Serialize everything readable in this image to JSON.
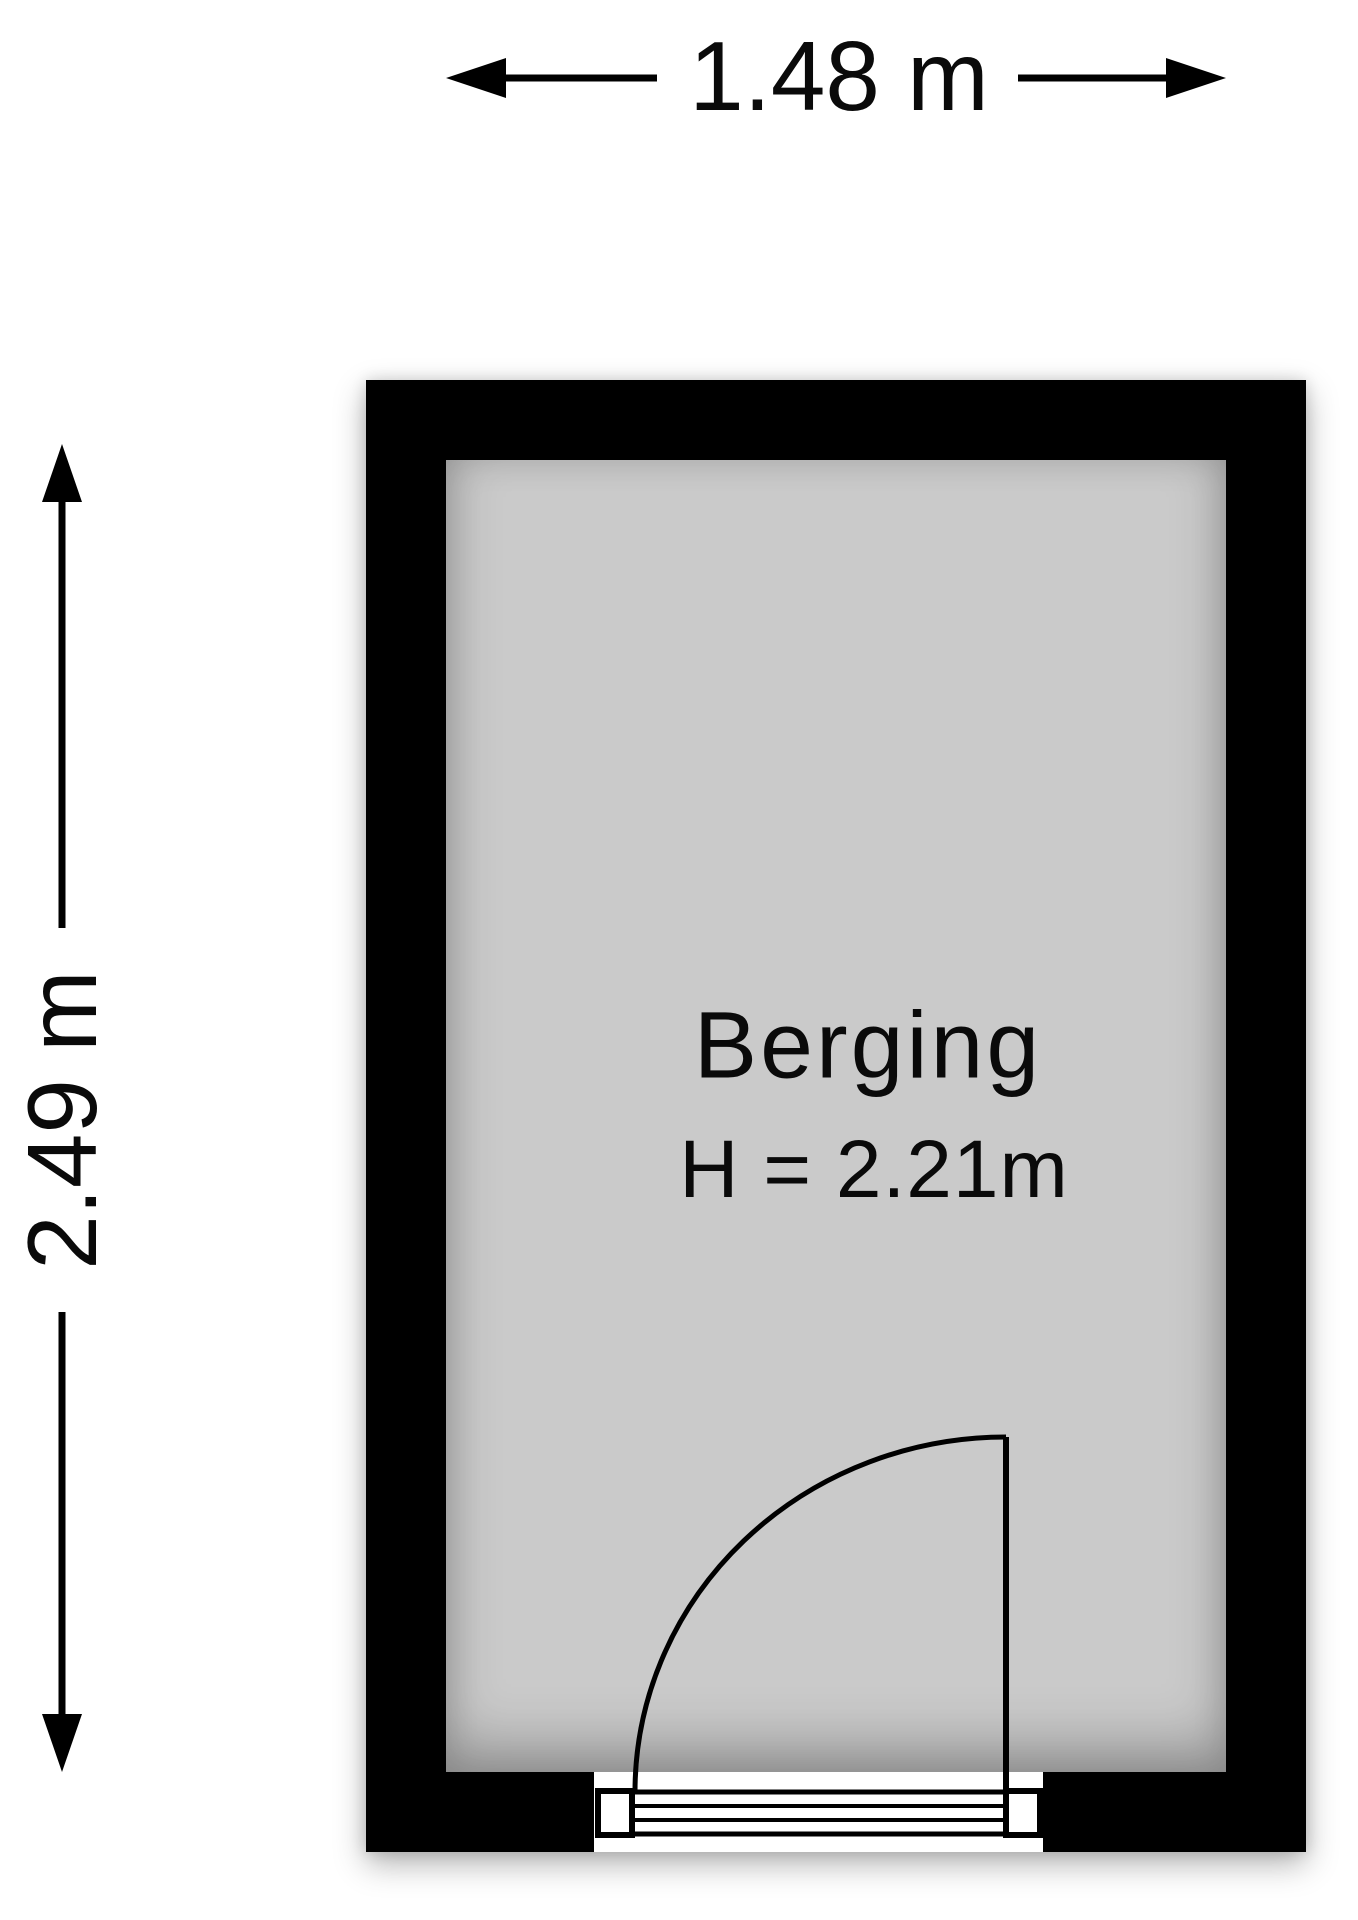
{
  "title": "Berging floor plan",
  "room": {
    "name": "Berging",
    "ceiling_height_label": "H = 2.21m",
    "width_label": "1.48 m",
    "depth_label": "2.49 m"
  },
  "door": {
    "location": "bottom wall",
    "symbol": "single swing door with quarter-circle arc and stepped threshold"
  },
  "colors": {
    "wall": "#000000",
    "floor": "#cacaca",
    "background": "#ffffff",
    "line": "#0a0a0a"
  }
}
